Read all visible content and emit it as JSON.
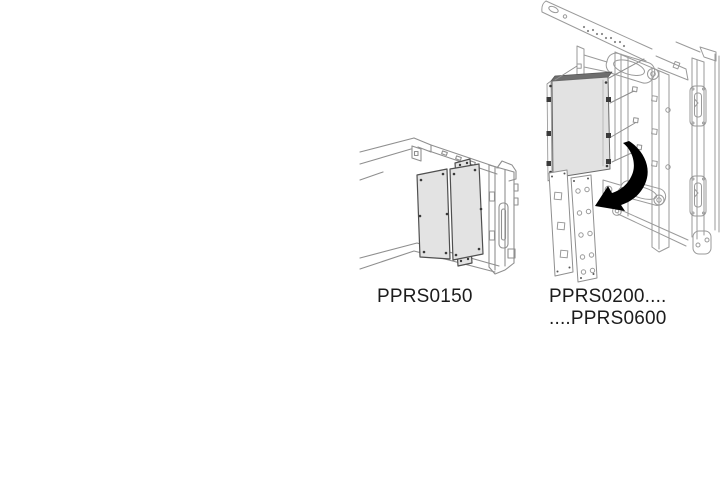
{
  "page": {
    "width": 720,
    "height": 481,
    "background": "#ffffff"
  },
  "illustrations": {
    "left": {
      "part_number": "PPRS0150"
    },
    "right": {
      "part_number_line1": "PPRS0200....",
      "part_number_line2": "....PPRS0600"
    }
  },
  "icons": {
    "assembly_arrow": "curved-black-arrow-down-left"
  },
  "colors": {
    "frame_line": "#9a9a9a",
    "frame_line_dark": "#8f8f8f",
    "panel_outline": "#4f4f4f",
    "panel_fill": "#e3e3e3",
    "panel_top_edge": "#6e6e6e",
    "clip_dark": "#3a3a3a",
    "arrow": "#000000",
    "label_text": "#1c1c1c"
  }
}
